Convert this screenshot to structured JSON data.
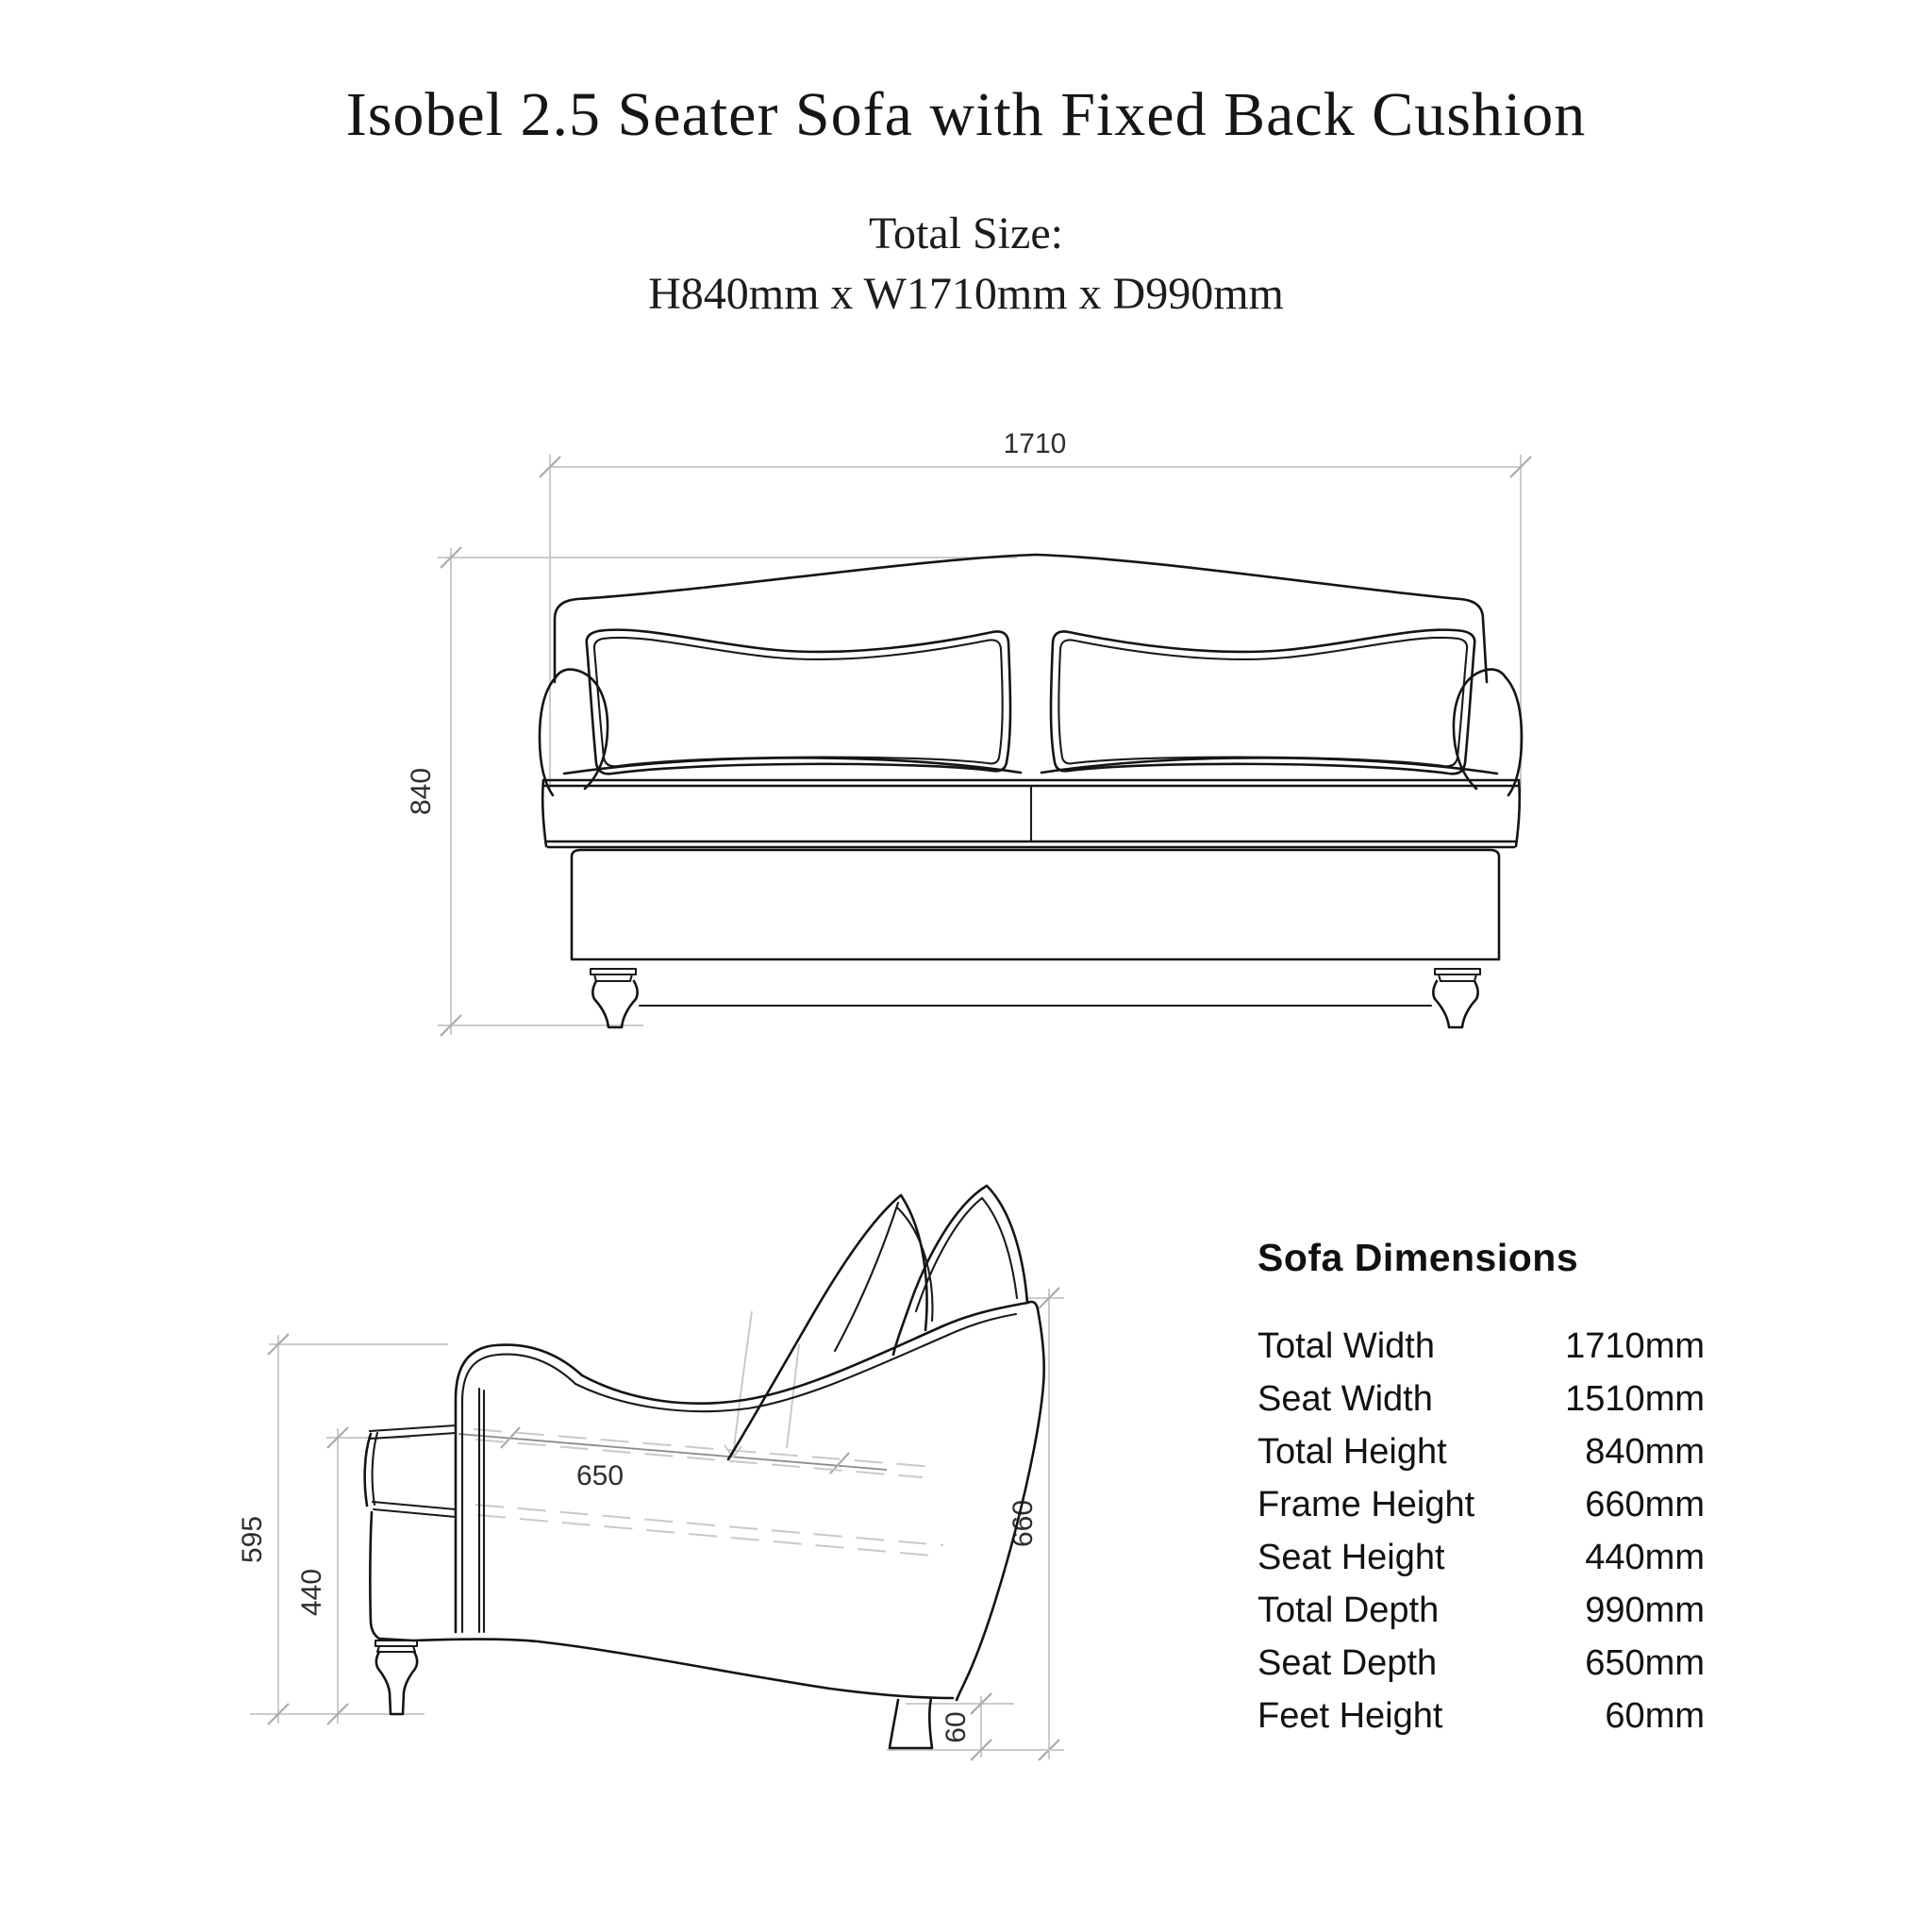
{
  "header": {
    "title": "Isobel 2.5 Seater Sofa with Fixed Back Cushion",
    "total_size_label": "Total Size:",
    "total_size_value": "H840mm x W1710mm x D990mm"
  },
  "front_view": {
    "width_dim": "1710",
    "height_dim": "840"
  },
  "side_view": {
    "arm_height_dim": "595",
    "seat_height_dim": "440",
    "seat_depth_dim": "650",
    "frame_height_dim": "660",
    "feet_height_dim": "60"
  },
  "dimensions_table": {
    "heading": "Sofa Dimensions",
    "rows": [
      {
        "label": "Total Width",
        "value": "1710mm"
      },
      {
        "label": "Seat Width",
        "value": "1510mm"
      },
      {
        "label": "Total Height",
        "value": "840mm"
      },
      {
        "label": "Frame Height",
        "value": "660mm"
      },
      {
        "label": "Seat Height",
        "value": "440mm"
      },
      {
        "label": "Total Depth",
        "value": "990mm"
      },
      {
        "label": "Seat Depth",
        "value": "650mm"
      },
      {
        "label": "Feet Height",
        "value": "60mm"
      }
    ]
  },
  "colors": {
    "background": "#ffffff",
    "drawing_line": "#141414",
    "dimension_line": "#cbcbcb",
    "dimension_text": "#2e2e2e",
    "table_text": "#121212"
  }
}
